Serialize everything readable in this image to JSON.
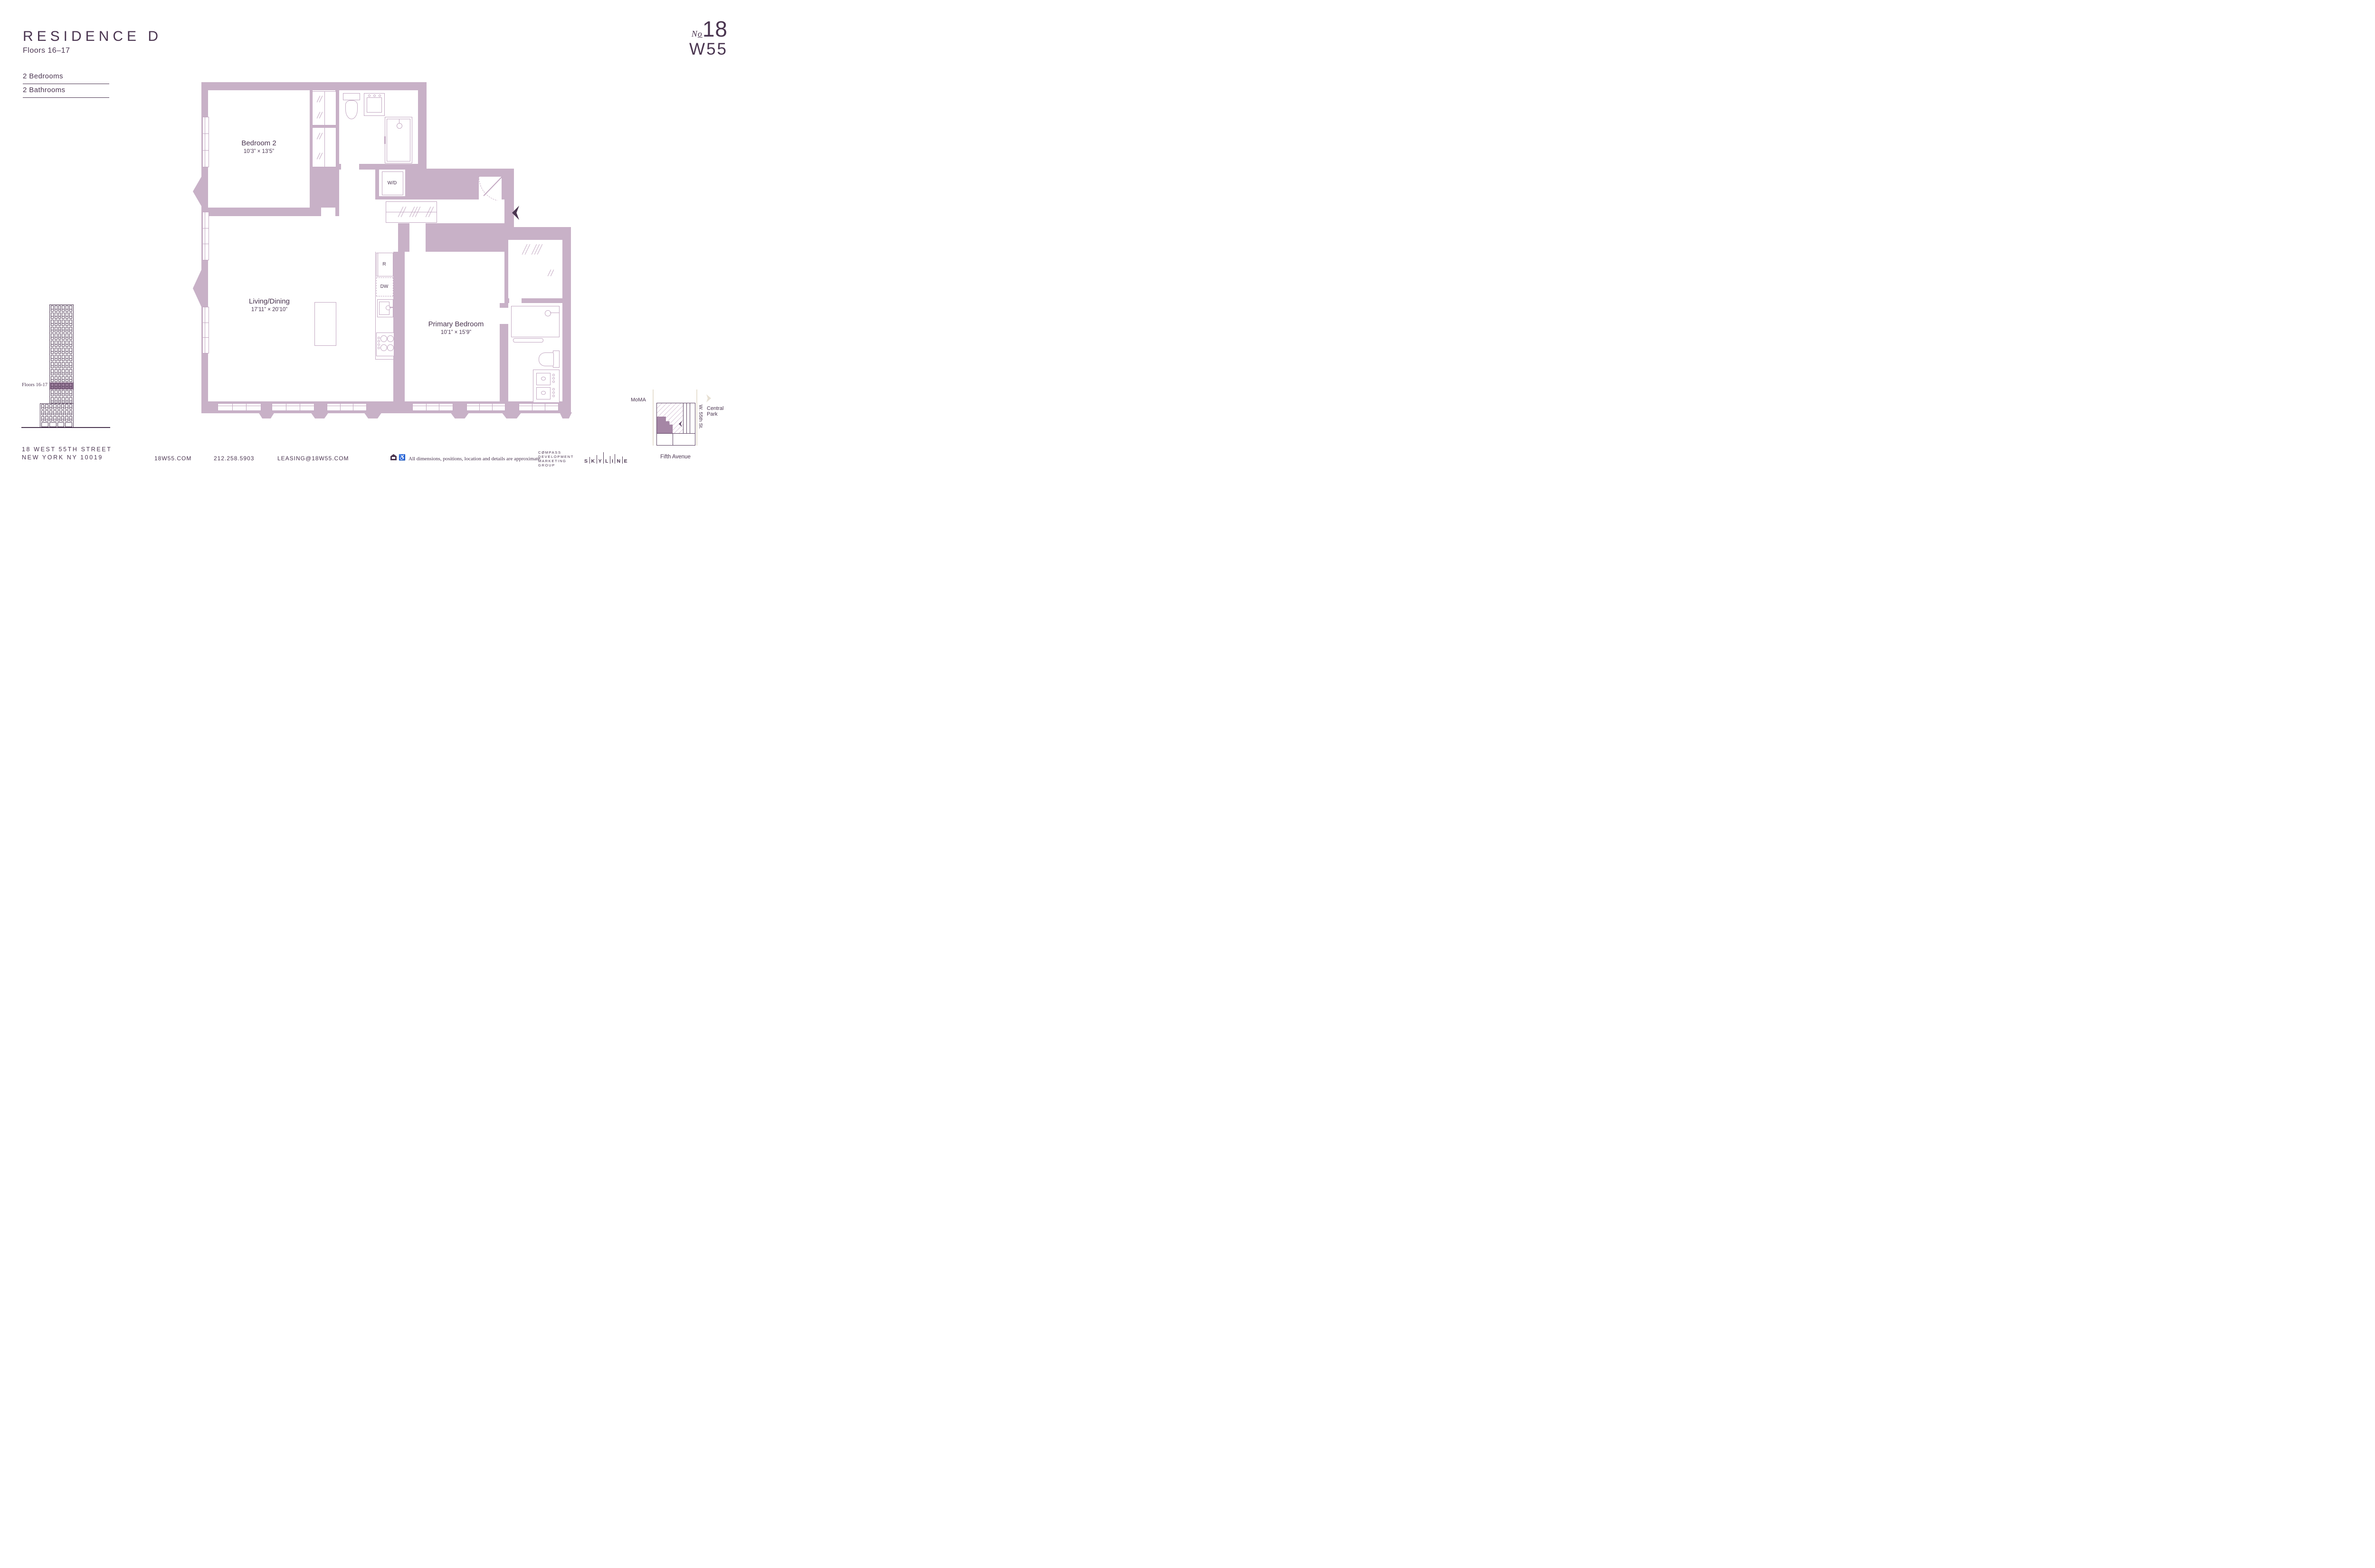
{
  "header": {
    "title": "RESIDENCE D",
    "floors": "Floors 16–17",
    "spec1": "2 Bedrooms",
    "spec2": "2 Bathrooms"
  },
  "logo": {
    "script": "N",
    "script_o": "o",
    "number": "18",
    "line2": "W55"
  },
  "rooms": {
    "bedroom2": {
      "name": "Bedroom 2",
      "dims": "10’3” × 13’5”"
    },
    "living": {
      "name": "Living/Dining",
      "dims": "17’11” × 20’10”"
    },
    "primary": {
      "name": "Primary Bedroom",
      "dims": "10’1” × 15’9”"
    }
  },
  "appliances": {
    "washer_dryer": "W/D",
    "refrigerator": "R",
    "dishwasher": "DW"
  },
  "building": {
    "label": "Floors 16-17"
  },
  "map": {
    "moma": "MoMA",
    "central_park": "Central Park",
    "street": "W. 55th St.",
    "avenue": "Fifth Avenue"
  },
  "footer": {
    "address1": "18 WEST 55TH STREET",
    "address2": "NEW YORK NY 10019",
    "website": "18W55.COM",
    "phone": "212.258.5903",
    "email": "LEASING@18W55.COM",
    "disclaimer": "All dimensions, positions, location and details are approximate.",
    "compass": {
      "l1": "CØMPASS",
      "l2": "DEVELOPMENT",
      "l3": "MARKETING",
      "l4": "GROUP"
    },
    "skyline": {
      "l0": "S",
      "l1": "K",
      "l2": "Y",
      "l3": "L",
      "l4": "I",
      "l5": "N",
      "l6": "E"
    }
  },
  "colors": {
    "ink": "#4A3550",
    "wall": "#C8B1C7",
    "line": "#C2A7C1",
    "band": "#A182A1",
    "street": "#E7E0D3",
    "map_fill": "#A586A5"
  }
}
